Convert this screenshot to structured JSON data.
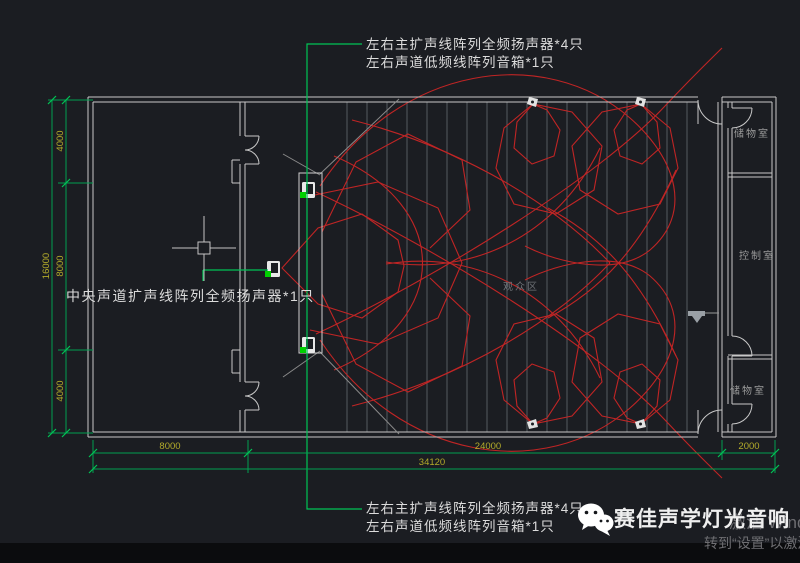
{
  "annotations": {
    "top_line1": "左右主扩声线阵列全频扬声器*4只",
    "top_line2": "左右声道低频线阵列音箱*1只",
    "center_channel": "中央声道扩声线阵列全频扬声器*1只",
    "bottom_line1": "左右主扩声线阵列全频扬声器*4只",
    "bottom_line2": "左右声道低频线阵列音箱*1只"
  },
  "rooms": {
    "storage_top": "储物室",
    "control_room": "控制室",
    "storage_bottom": "储物室",
    "audience_area": "观众区"
  },
  "dimensions": {
    "left_total": "16000",
    "left_top": "4000",
    "left_middle": "8000",
    "left_bottom": "4000",
    "bottom_stage": "8000",
    "bottom_audience": "24000",
    "bottom_rooms": "2000",
    "bottom_total": "34120"
  },
  "footer": {
    "brand_name": "赛佳声学灯光音响",
    "wechat_icon": "wechat-logo",
    "watermark_line1": "激活 Windows",
    "watermark_line2": "转到“设置”以激活Windows"
  },
  "colors": {
    "background": "#1b1d22",
    "wall": "#c8c8c8",
    "coverage_red": "#c02525",
    "leader_green": "#00c455",
    "dimension_green": "#00a050",
    "dimension_text": "#b3ab2a",
    "row_line": "#565a60"
  }
}
